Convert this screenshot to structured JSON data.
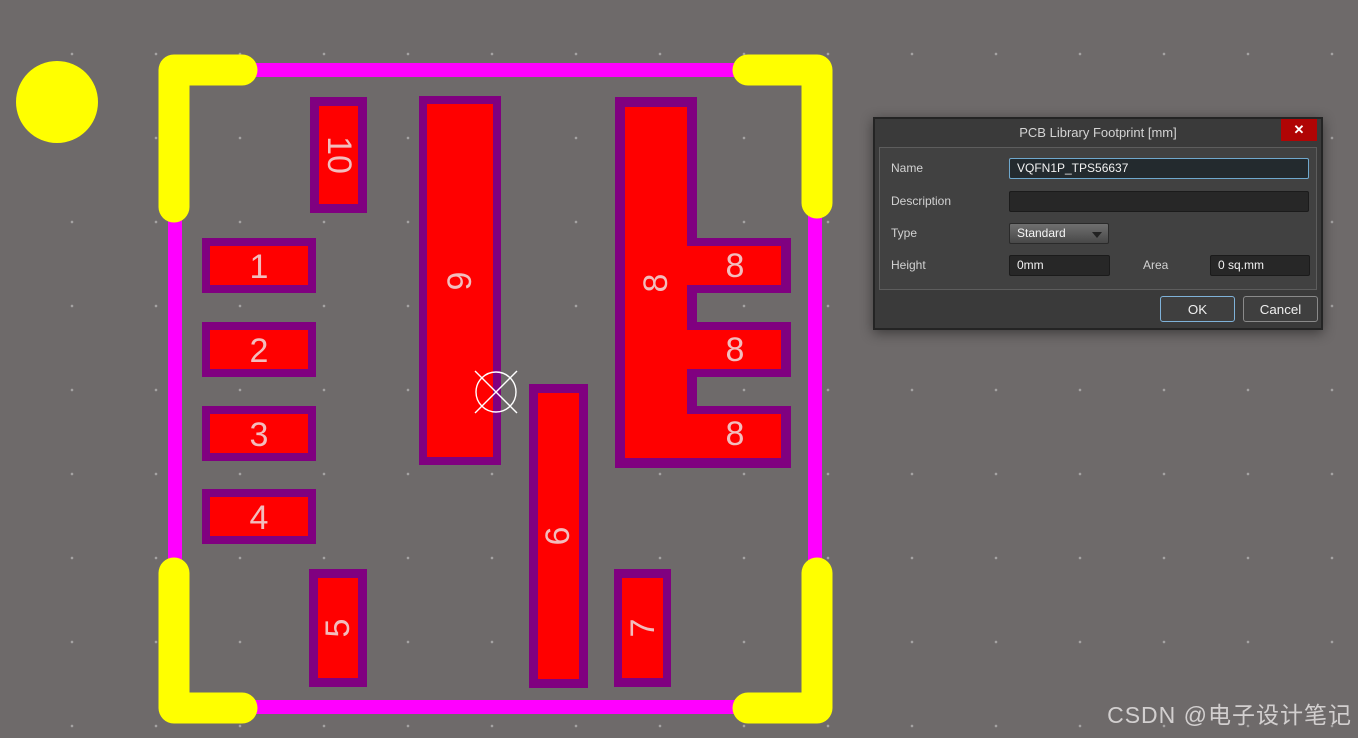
{
  "canvas": {
    "background": "#6e6a6a",
    "colors": {
      "pad_red": "#ff0000",
      "pad_border_purple": "#800080",
      "outline_magenta": "#ff00ff",
      "corner_yellow": "#ffff00",
      "pad_text": "#f2bdbd"
    },
    "pads": {
      "p1": {
        "label": "1"
      },
      "p2": {
        "label": "2"
      },
      "p3": {
        "label": "3"
      },
      "p4": {
        "label": "4"
      },
      "p5": {
        "label": "5"
      },
      "p6": {
        "label": "6"
      },
      "p7": {
        "label": "7"
      },
      "p8": {
        "label": "8"
      },
      "p9": {
        "label": "9"
      },
      "p10": {
        "label": "10"
      }
    }
  },
  "dialog": {
    "title": "PCB Library Footprint [mm]",
    "close_icon": "✕",
    "fields": {
      "name": {
        "label": "Name",
        "value": "VQFN1P_TPS56637"
      },
      "description": {
        "label": "Description",
        "value": ""
      },
      "type": {
        "label": "Type",
        "value": "Standard"
      },
      "height": {
        "label": "Height",
        "value": "0mm"
      },
      "area": {
        "label": "Area",
        "value": "0 sq.mm"
      }
    },
    "buttons": {
      "ok": "OK",
      "cancel": "Cancel"
    }
  },
  "watermark": "CSDN @电子设计笔记"
}
